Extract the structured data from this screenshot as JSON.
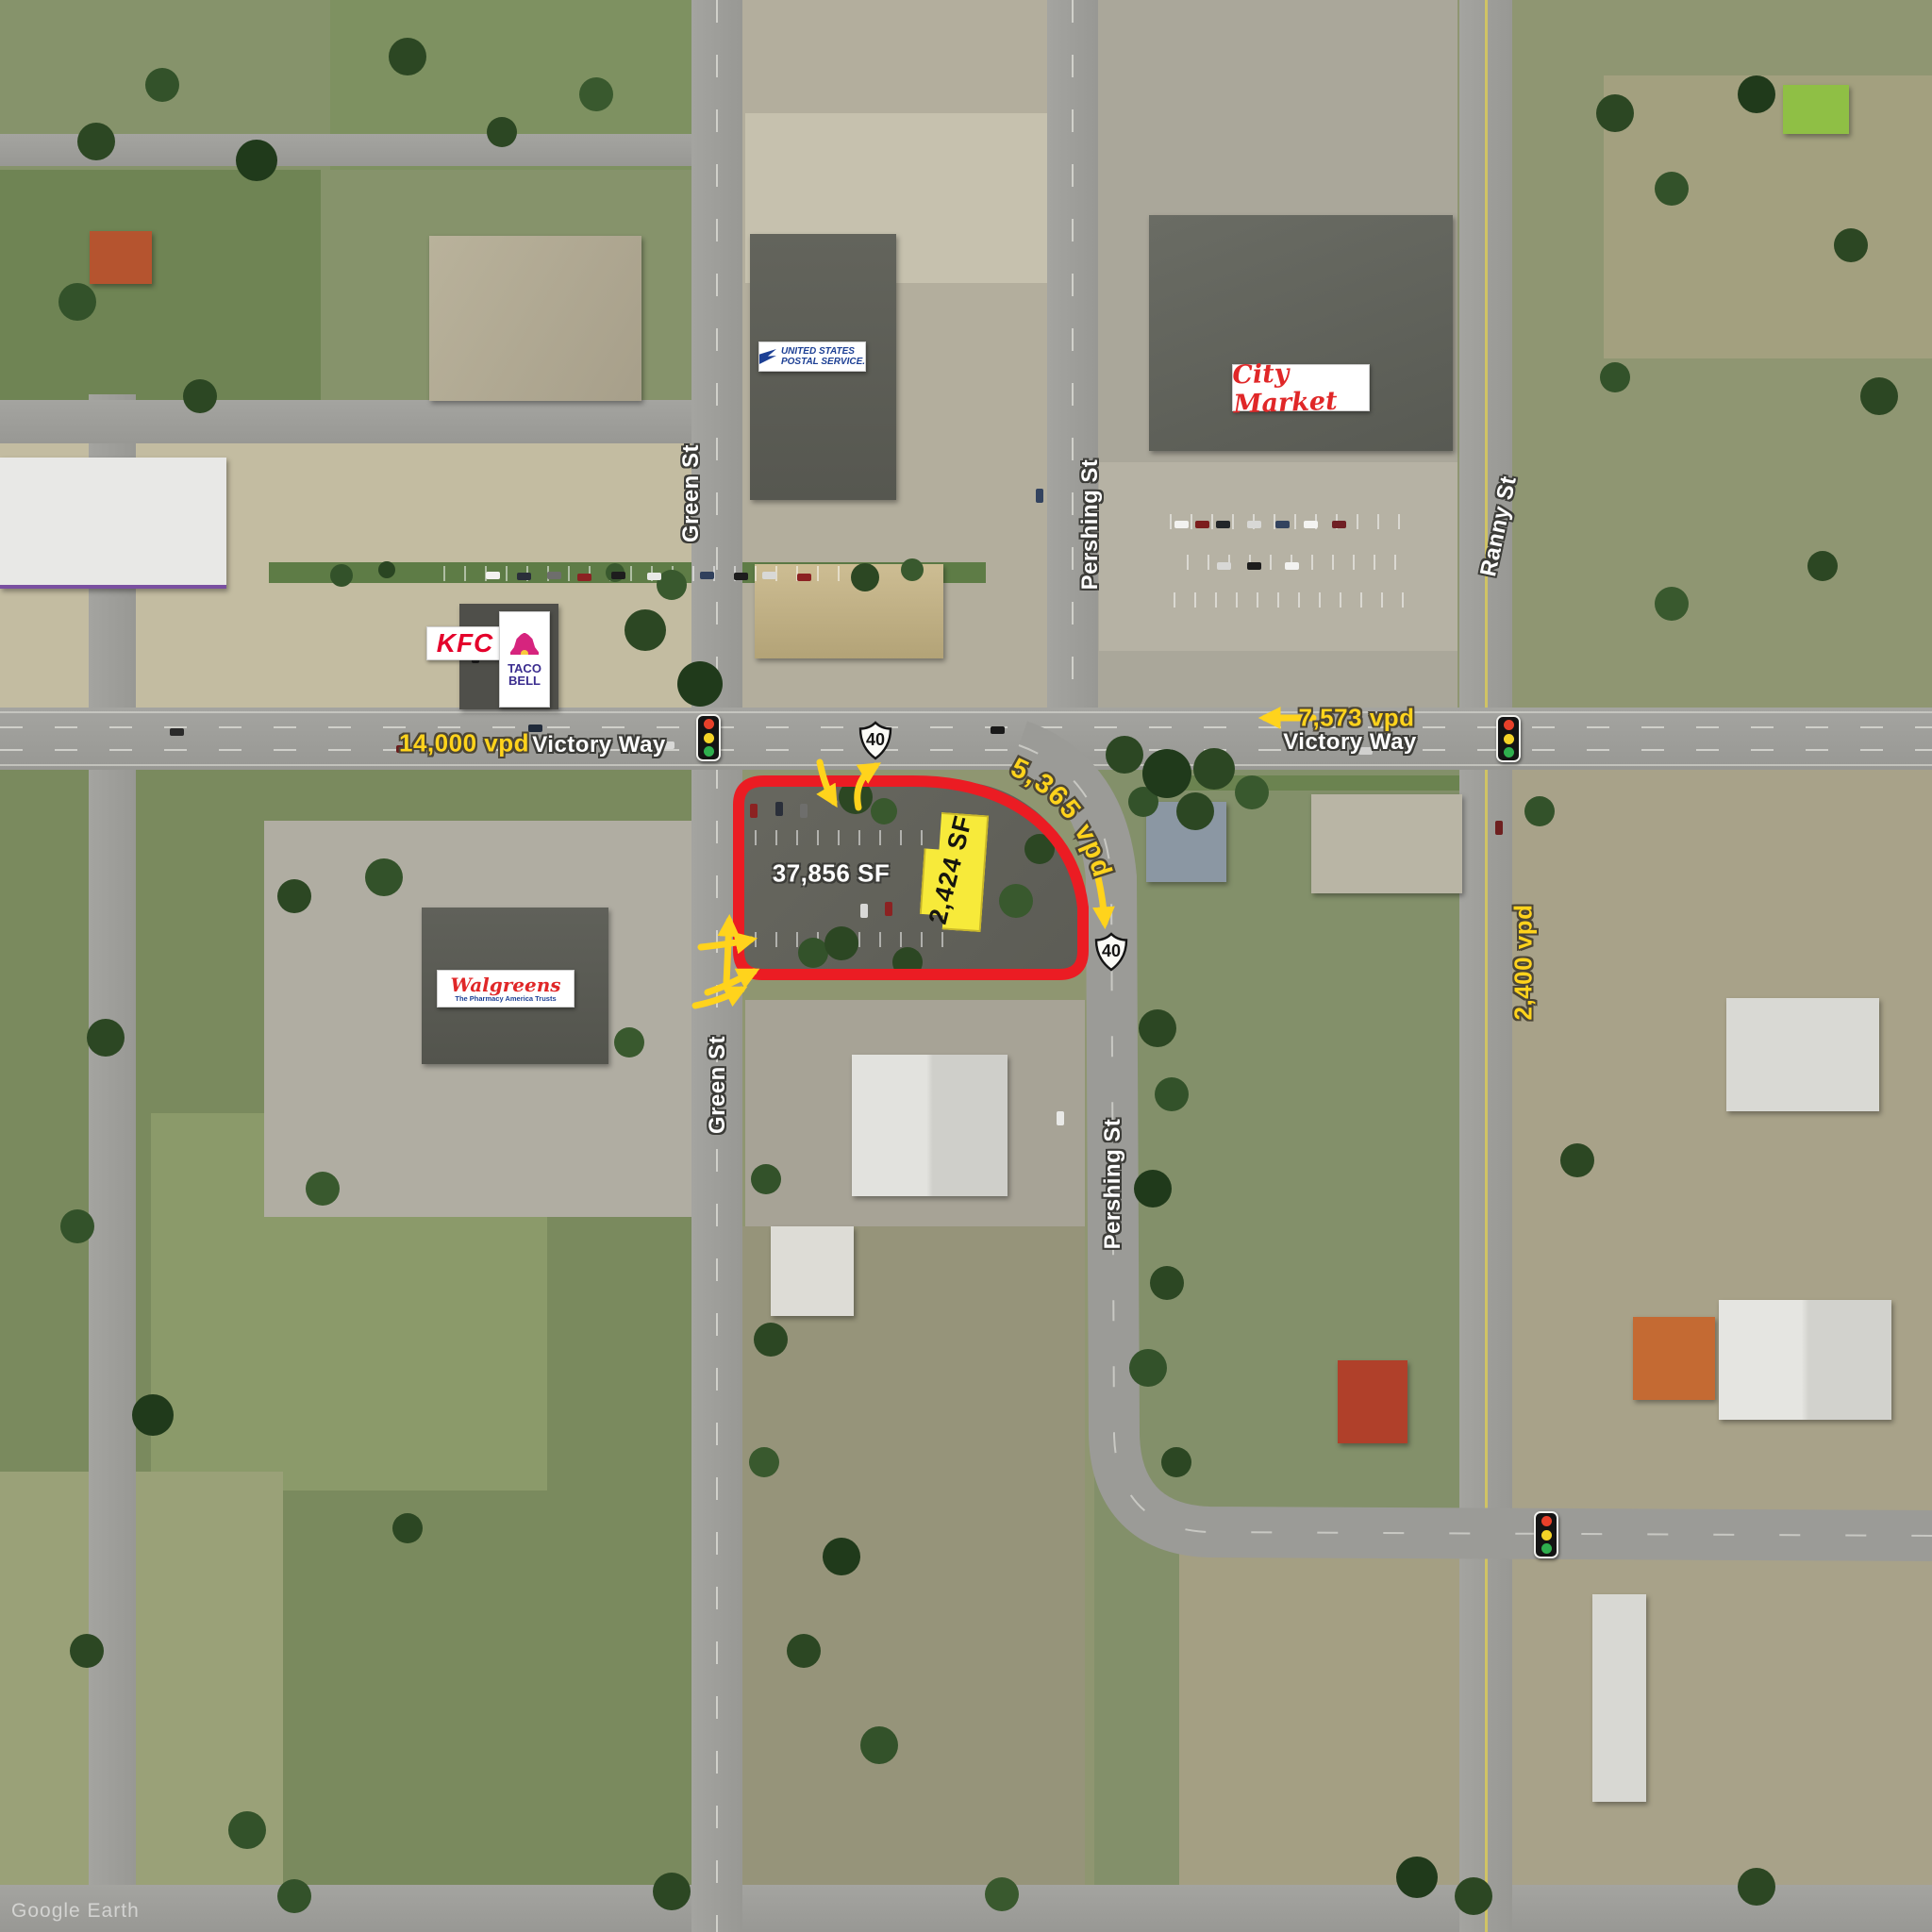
{
  "map": {
    "type": "aerial-site-map",
    "watermark": "Google Earth",
    "parcel": {
      "site_area": "37,856 SF",
      "building_area": "2,424 SF",
      "outline_color": "#eb1c23",
      "building_highlight_color": "#f7ea3a"
    },
    "streets": {
      "green_st_north": "Green St",
      "pershing_st_north": "Pershing St",
      "ranny_st": "Ranny St",
      "victory_way_west": "Victory Way",
      "victory_way_east": "Victory Way",
      "green_st_south": "Green St",
      "pershing_st_south": "Pershing St"
    },
    "traffic_counts": {
      "victory_way_west": "14,000 vpd",
      "victory_way_east": "7,573 vpd",
      "pershing_curve": "5,365 vpd",
      "ranny_st": "2,400 vpd"
    },
    "route_shields": {
      "us40_a": "40",
      "us40_b": "40"
    },
    "businesses": {
      "kfc": "KFC",
      "taco_bell_line1": "TACO",
      "taco_bell_line2": "BELL",
      "usps_line1": "UNITED STATES",
      "usps_line2": "POSTAL SERVICE.",
      "city_market": "City Market",
      "walgreens": "Walgreens",
      "walgreens_tagline": "The Pharmacy America Trusts"
    },
    "colors": {
      "street_label_text": "#ffffff",
      "traffic_count_text": "#ffd31c",
      "signal_red": "#e8402a",
      "signal_yellow": "#f5d327",
      "signal_green": "#2faf4e"
    }
  }
}
